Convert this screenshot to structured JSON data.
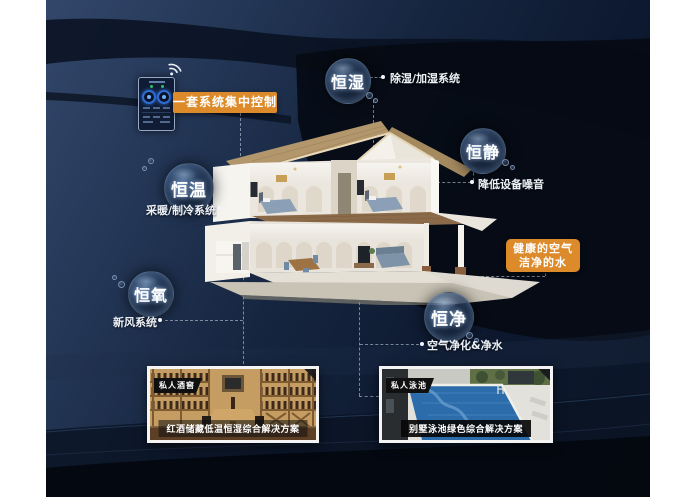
{
  "colors": {
    "accent_orange": "#dd8a2a",
    "canvas_navy": "#16253f",
    "swoosh_dark": "#060a13",
    "bubble_text": "#ffffff"
  },
  "control_panel": {
    "label": "一套系统集中控制",
    "wifi_icon": "wifi-icon"
  },
  "bubbles": [
    {
      "label": "恒湿",
      "desc": "除湿/加湿系统"
    },
    {
      "label": "恒静",
      "desc": "降低设备噪音"
    },
    {
      "label": "恒温",
      "desc": "采暖/制冷系统"
    },
    {
      "label": "恒氧",
      "desc": "新风系统"
    },
    {
      "label": "恒净",
      "desc": "空气净化&净水"
    }
  ],
  "highlight_box": {
    "line1": "健康的空气",
    "line2": "洁净的水"
  },
  "cards": [
    {
      "tag": "私人酒窖",
      "caption": "红酒储藏低温恒湿综合解决方案"
    },
    {
      "tag": "私人泳池",
      "caption": "别墅泳池绿色综合解决方案"
    }
  ]
}
